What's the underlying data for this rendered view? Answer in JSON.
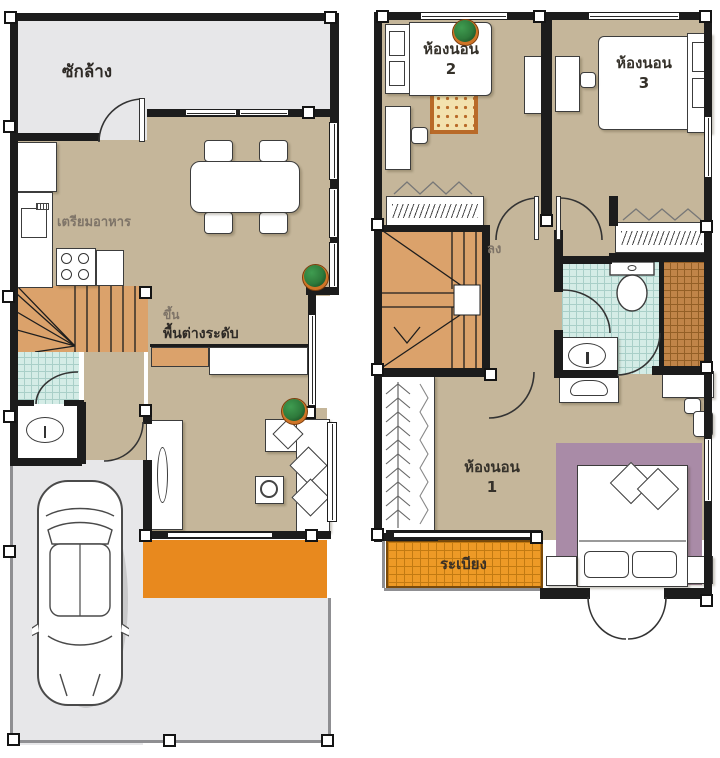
{
  "document": {
    "type": "two-storey house floor plan",
    "floors": [
      "first-floor",
      "second-floor"
    ]
  },
  "palette": {
    "wall": "#1c1c1c",
    "tan": "#c5b69a",
    "gray": "#e7e7e9",
    "stair": "#dba26b",
    "porch": "#e8891e",
    "balcony": "#ee9a26",
    "balcony-line": "#c27a12",
    "tile-blue": "#d4ece6",
    "tile-blue-line": "#a9cfc8",
    "tile-brown": "#c08448",
    "tile-brown-line": "#935f26",
    "purple": "#a98ba7",
    "rug-border": "#b96a28",
    "rug-fill": "#f3e2ae",
    "text-dark": "#2e2a26",
    "text-muted": "#7e7468",
    "furn-line": "#3c3c3c",
    "plant-green": "#2e7a3b",
    "plant-pot": "#cf7426"
  },
  "floor1": {
    "labels": {
      "laundry": "ซักล้าง",
      "kitchen": "เตรียมอาหาร",
      "stairs_up": "ขึ้น",
      "split_level": "พื้นต่างระดับ"
    }
  },
  "floor2": {
    "labels": {
      "stairs_down": "ลง",
      "balcony": "ระเบียง",
      "bedroom1_line1": "ห้องนอน",
      "bedroom1_line2": "1",
      "bedroom2_line1": "ห้องนอน",
      "bedroom2_line2": "2",
      "bedroom3_line1": "ห้องนอน",
      "bedroom3_line2": "3"
    }
  }
}
